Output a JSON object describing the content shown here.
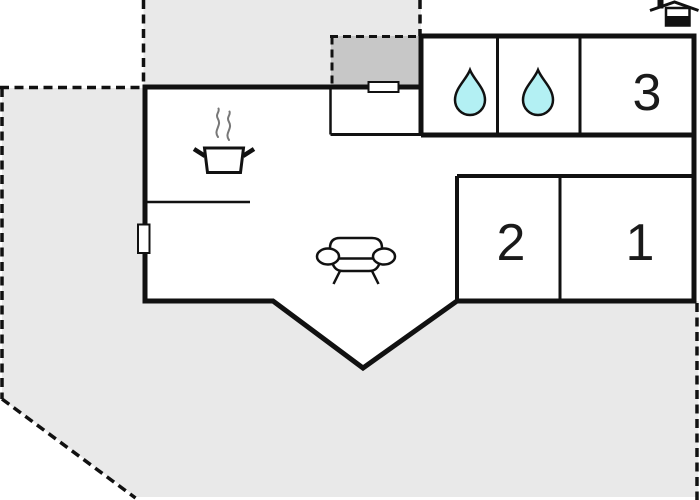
{
  "plan": {
    "name": "holiday-home-floor-plan",
    "rooms": [
      {
        "id": "room-1",
        "label": "1"
      },
      {
        "id": "room-2",
        "label": "2"
      },
      {
        "id": "room-3",
        "label": "3"
      }
    ],
    "features": [
      {
        "room": "bathroom-1",
        "icon": "water-drop-icon"
      },
      {
        "room": "bathroom-2",
        "icon": "water-drop-icon"
      },
      {
        "room": "kitchen",
        "icon": "cooking-pot-icon"
      },
      {
        "room": "living-room",
        "icon": "sofa-icon"
      },
      {
        "room": "exterior",
        "icon": "house-icon"
      }
    ],
    "colors": {
      "background": "#ffffff",
      "property_fill": "#e9e9e9",
      "terrace_fill": "#c7c7c7",
      "wall": "#111111",
      "room_fill": "#ffffff",
      "water_drop_fill": "#b3f0f3",
      "steam": "#777777"
    }
  }
}
